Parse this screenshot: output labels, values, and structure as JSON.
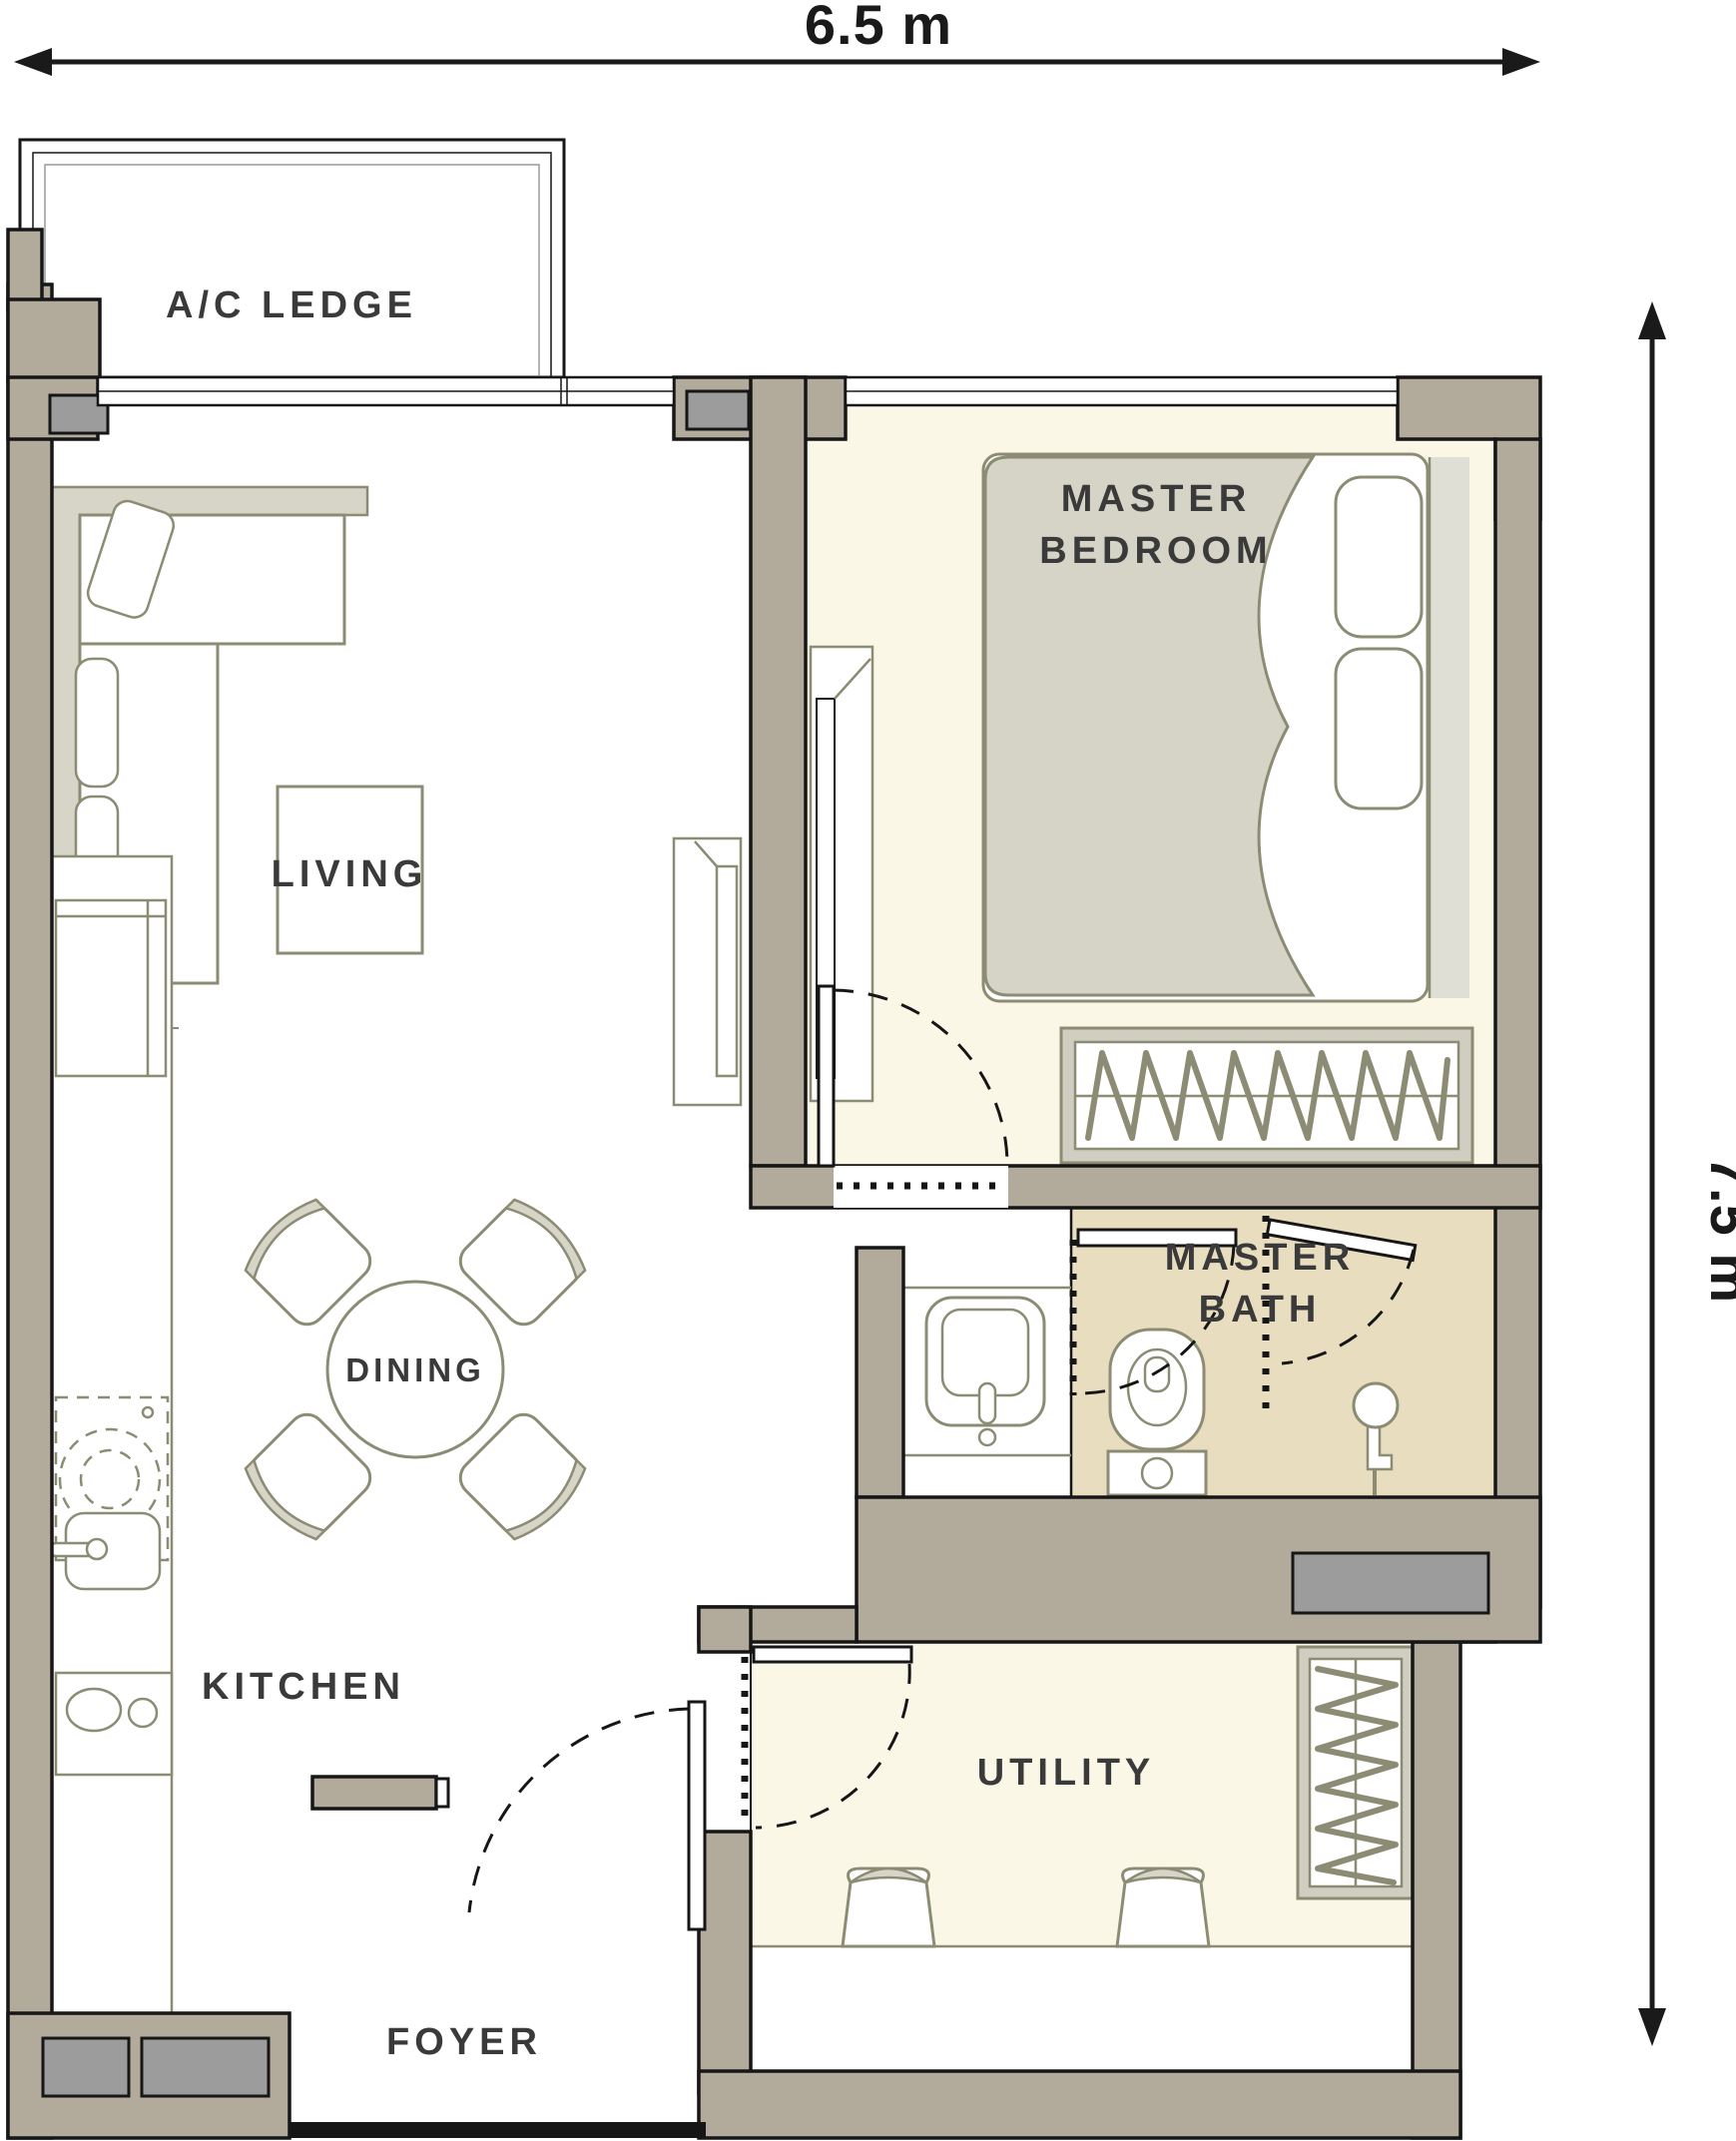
{
  "title": "Apartment unit floor plan",
  "dimensions": {
    "width_label": "6.5 m",
    "height_label": "7.5 m"
  },
  "labels": {
    "ac_ledge": "A/C LEDGE",
    "living": "LIVING",
    "dining": "DINING",
    "kitchen": "KITCHEN",
    "utility": "UTILITY",
    "foyer": "FOYER",
    "bedroom_line1": "MASTER",
    "bedroom_line2": "BEDROOM",
    "bath_line1": "MASTER",
    "bath_line2": "BATH"
  },
  "colors": {
    "wall": "#b2ab9b",
    "wall_outline": "#161616",
    "bedroom_fill": "#fbf7e6",
    "utility_fill": "#fbf7e6",
    "bath_fill": "#e8debf",
    "column_gray": "#9c9c9c",
    "furniture_stroke": "#8c8c74",
    "upholstery_fill": "#d6d5c8",
    "label_text": "#3a3a3a",
    "dimension_text": "#1a1a1a"
  },
  "symbols": [
    "l-sofa-icon",
    "coffee-table-icon",
    "ceiling-fan-icon",
    "tv-console-icon",
    "double-bed-icon",
    "pillow-icon",
    "wardrobe-hangers-icon",
    "dining-table-icon",
    "dining-chair-icon",
    "fridge-icon",
    "washing-machine-icon",
    "kitchen-sink-icon",
    "hob-icon",
    "vanity-basin-icon",
    "toilet-icon",
    "shower-head-icon",
    "desk-stool-icon",
    "door-swing-icon",
    "window-icon",
    "dimension-arrow-icon"
  ]
}
